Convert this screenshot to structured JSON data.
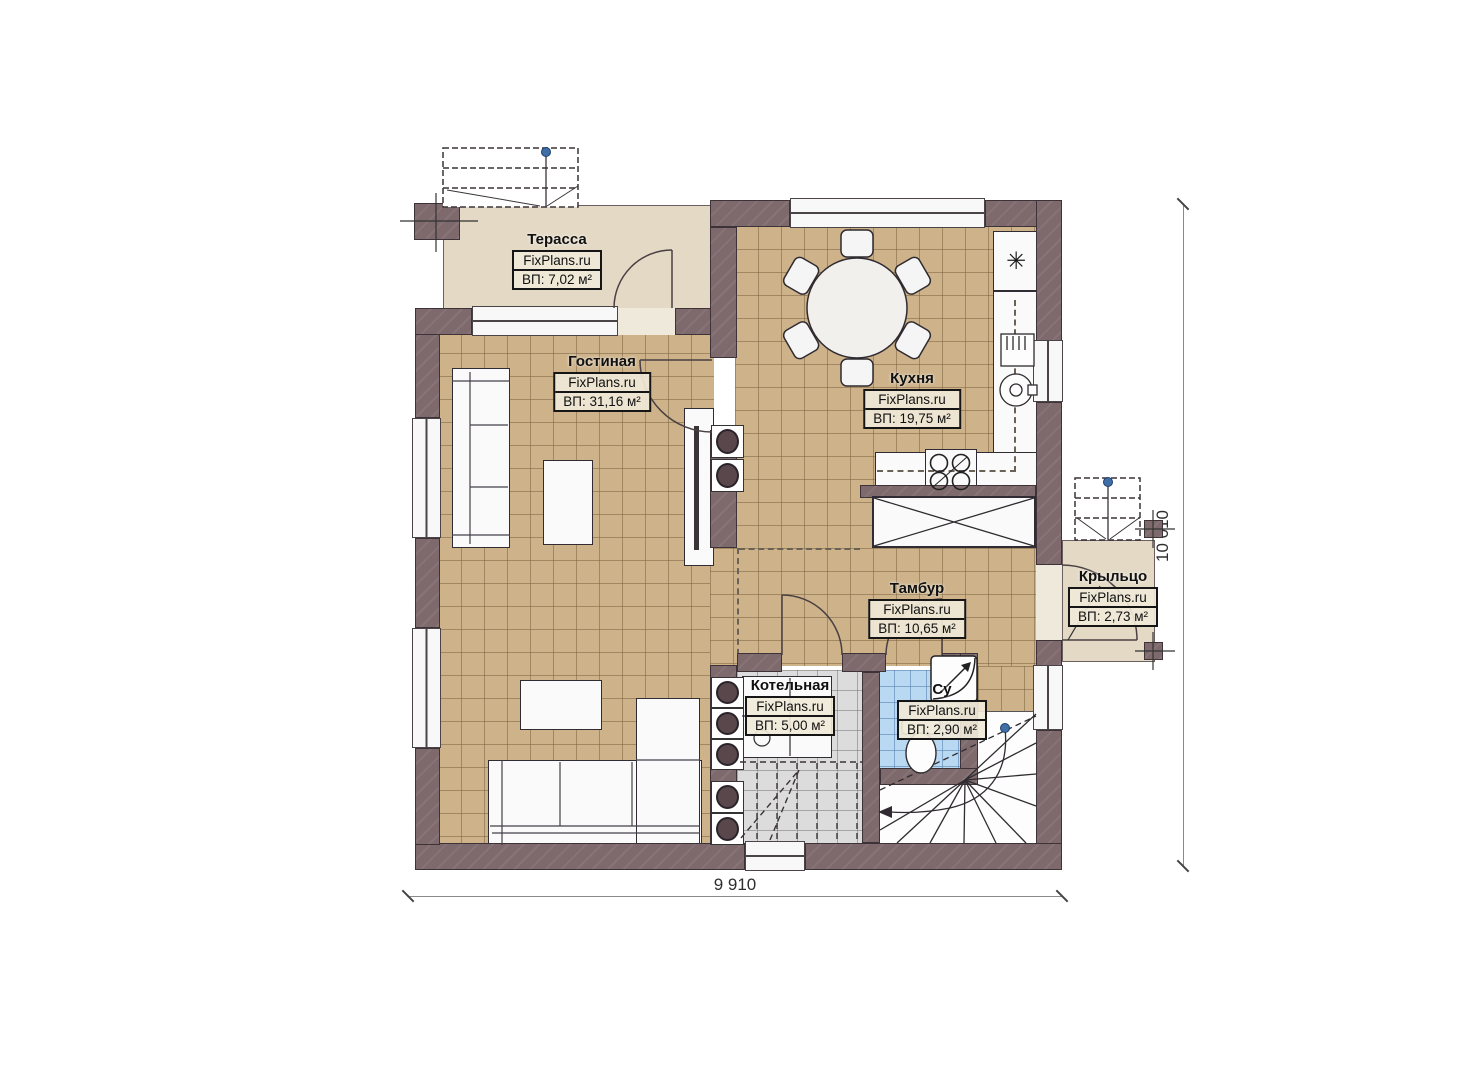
{
  "rooms": {
    "terrace": {
      "name": "Терасса",
      "site": "FixPlans.ru",
      "area": "ВП: 7,02 м²"
    },
    "living": {
      "name": "Гостиная",
      "site": "FixPlans.ru",
      "area": "ВП: 31,16 м²"
    },
    "kitchen": {
      "name": "Кухня",
      "site": "FixPlans.ru",
      "area": "ВП: 19,75 м²"
    },
    "tambour": {
      "name": "Тамбур",
      "site": "FixPlans.ru",
      "area": "ВП: 10,65 м²"
    },
    "boiler": {
      "name": "Котельная",
      "site": "FixPlans.ru",
      "area": "ВП: 5,00 м²"
    },
    "bathroom": {
      "name": "Су",
      "site": "FixPlans.ru",
      "area": "ВП: 2,90 м²"
    },
    "porch": {
      "name": "Крыльцо",
      "site": "FixPlans.ru",
      "area": "ВП: 2,73 м²"
    }
  },
  "dimensions": {
    "width_label": "9 910",
    "height_label": "10 010"
  },
  "icons": {
    "snowflake": "✳"
  },
  "colors": {
    "wall_fill": "#7e6a6d",
    "floor_tan": "#cdb28a",
    "floor_gray": "#dcdcdc",
    "floor_blue": "#b9d8f2",
    "floor_beige": "#e3d9c5",
    "walkline_dot": "#3f6ea8"
  }
}
